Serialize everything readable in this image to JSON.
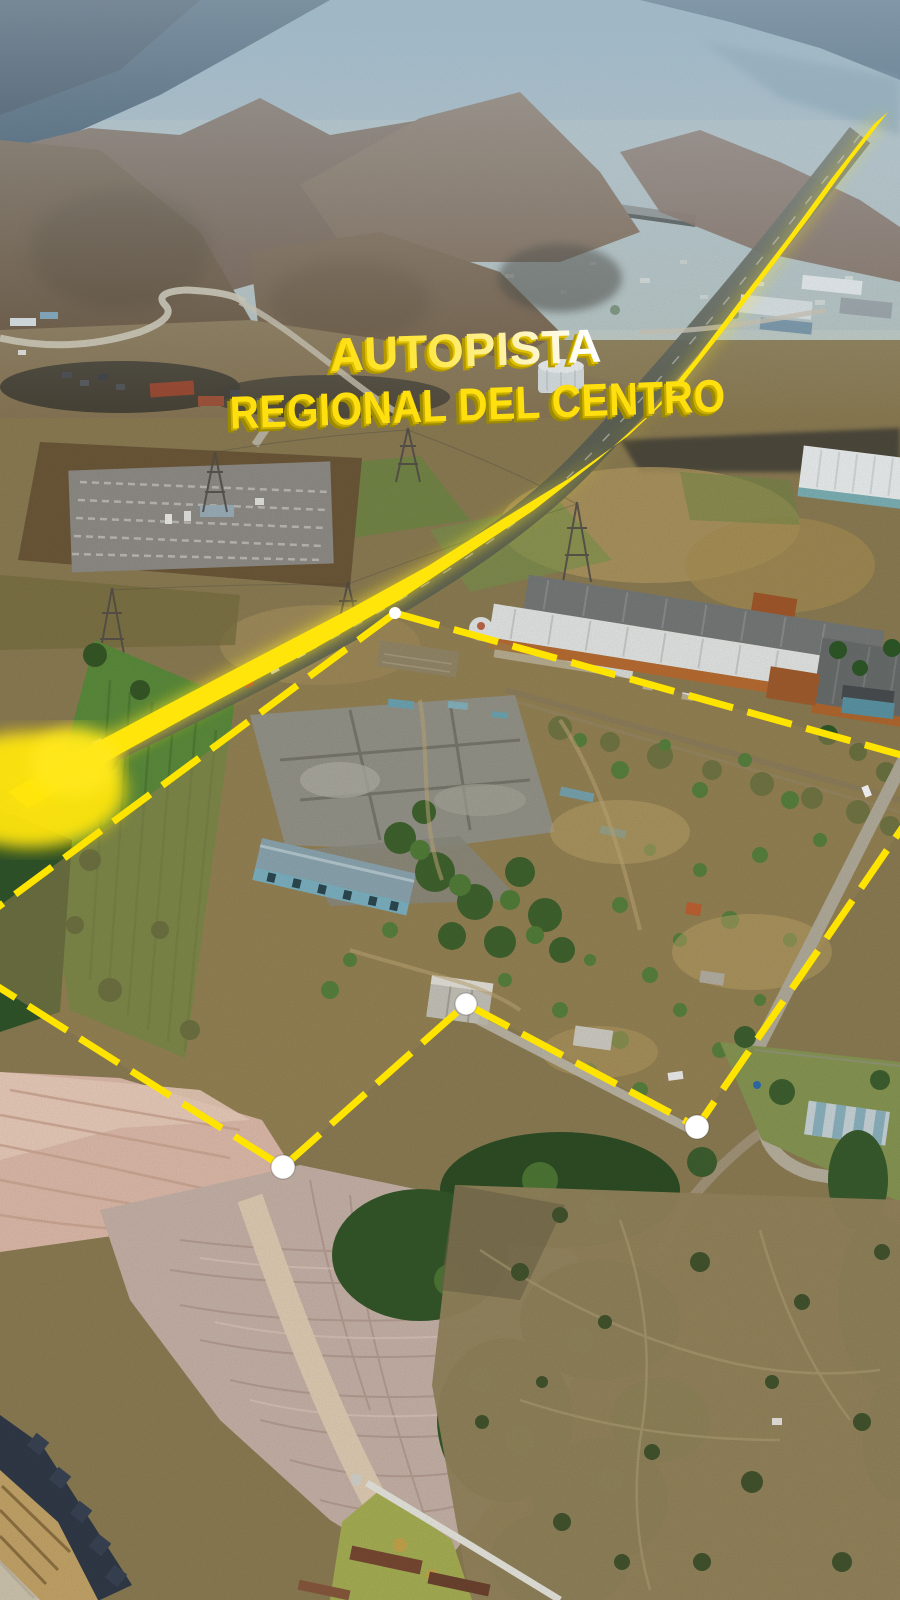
{
  "scene": {
    "type": "aerial-drone-photo",
    "description": "Aerial view of an industrial land parcel outlined in yellow beside a highlighted highway, mountains and hazy valley in the distance",
    "landmarks": {
      "highway": "highlighted highway running diagonally from top-right to lower-left",
      "substation": "electrical substation grid at mid-left",
      "warehouse": "large industrial warehouse with white and grey roofs",
      "parcel": "abandoned industrial parcel with ruins outlined by dashed yellow boundary",
      "sand_pit": "pink graded earth area at bottom-left"
    }
  },
  "title": {
    "line1": "AUTOPISTA",
    "line2": "REGIONAL DEL CENTRO"
  },
  "annotations": {
    "highway_color": "#ffe50a",
    "highway_glow_color": "#ffe81f",
    "boundary_color": "#ffe400",
    "marker_color": "#ffffff",
    "title_yellow": "#ffdf0e",
    "title_shadow": "#9c8a00",
    "highway_band_path": "M888,112 L851,160 L809,218 L765,276 L721,334 L677,390 L628,436 L568,479 L501,520 L428,566 L346,611 L256,658 L161,708 L60,762 L8,792 L28,808 L120,754 L218,700 L312,650 L398,601 L468,554 L534,510 L598,460 L652,412 L698,356 L742,298 L788,238 L832,178 L874,124 Z",
    "boundary_points": "395,613 944,767 697,1127 466,1004 283,1167 -60,950 395,613",
    "vertex_markers": [
      {
        "cx": "697",
        "cy": "1127",
        "r": "12"
      },
      {
        "cx": "466",
        "cy": "1004",
        "r": "11"
      },
      {
        "cx": "283",
        "cy": "1167",
        "r": "12"
      },
      {
        "cx": "395",
        "cy": "613",
        "r": "6"
      }
    ]
  }
}
